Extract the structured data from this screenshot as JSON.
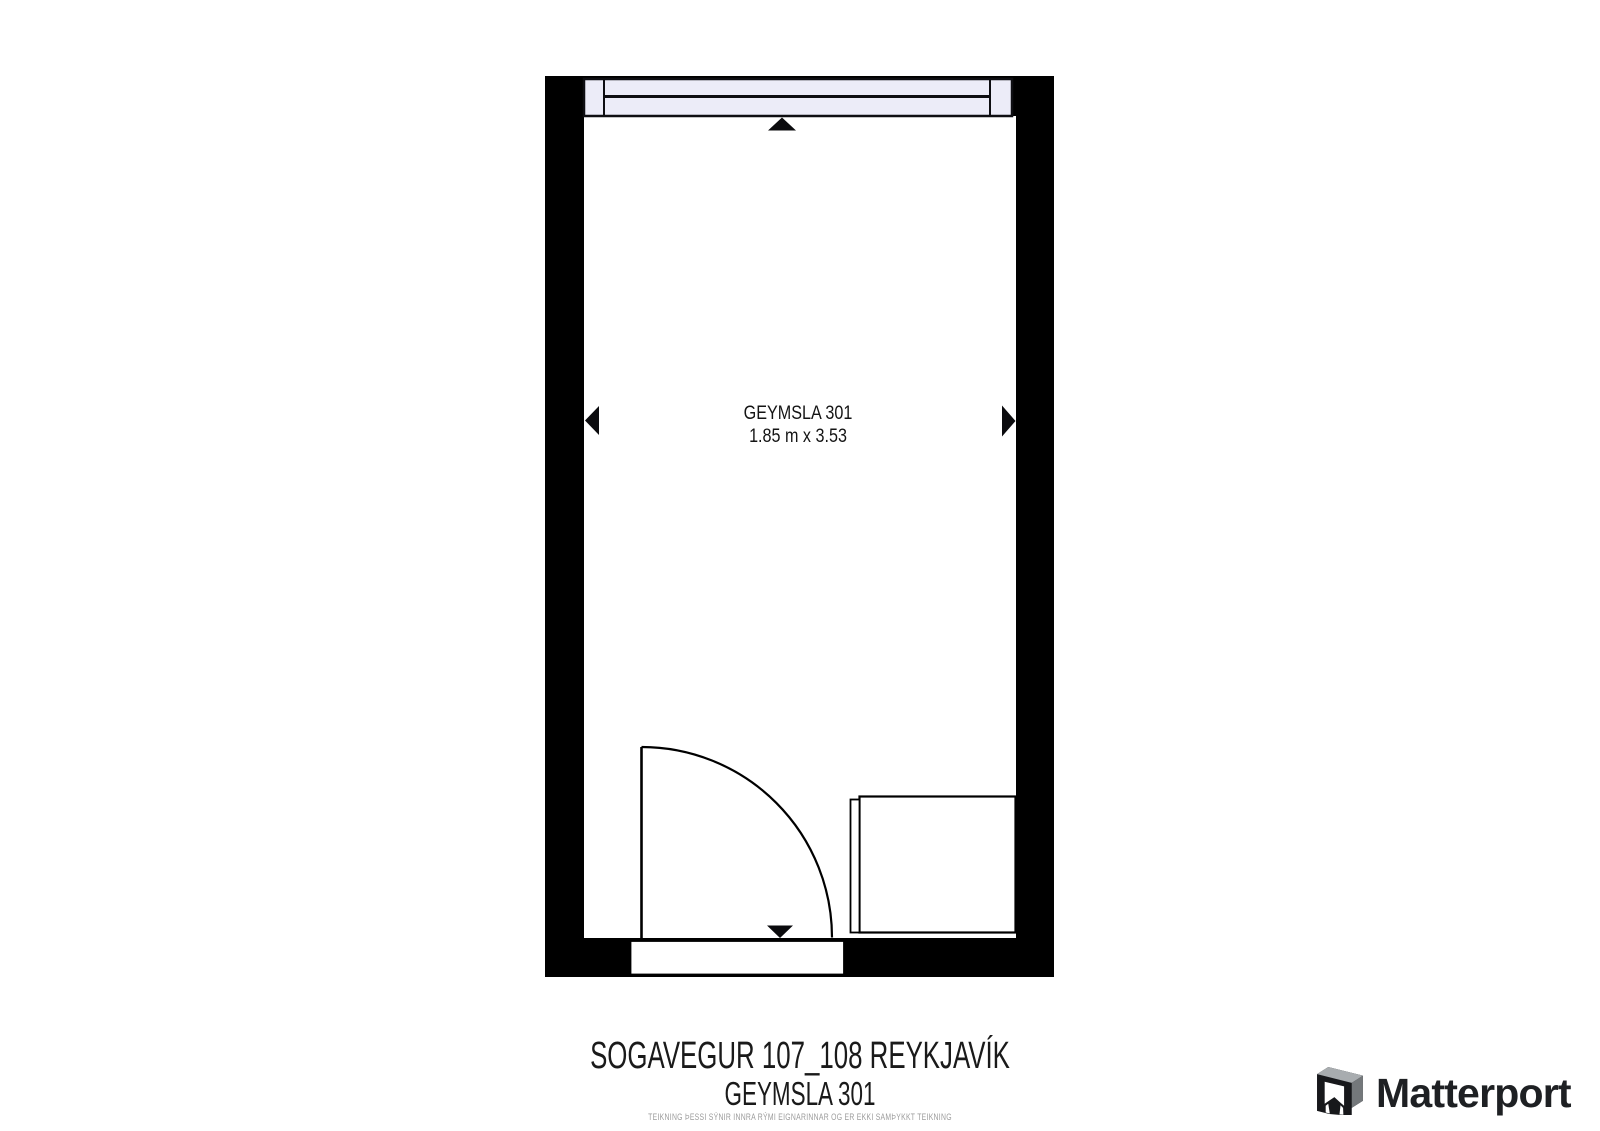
{
  "plan": {
    "room_label": "GEYMSLA 301",
    "room_dimensions": "1.85 m x 3.53"
  },
  "caption": {
    "title": "SOGAVEGUR 107_108 REYKJAVÍK",
    "subtitle": "GEYMSLA 301",
    "disclaimer": "TEIKNING ÞESSI SÝNIR INNRA RÝMI EIGNARINNAR OG ER EKKI SAMÞYKKT TEIKNING"
  },
  "branding": {
    "logo_text": "Matterport"
  },
  "colors": {
    "wall": "#000000",
    "window_fill": "#ececf8",
    "plan_text": "#141414",
    "caption_text": "#1a1a1a",
    "disclaimer_text": "#9b9b9b",
    "logo_text": "#1e2023",
    "logo_gray_top": "#a8acaf",
    "logo_gray_side": "#74787b"
  }
}
